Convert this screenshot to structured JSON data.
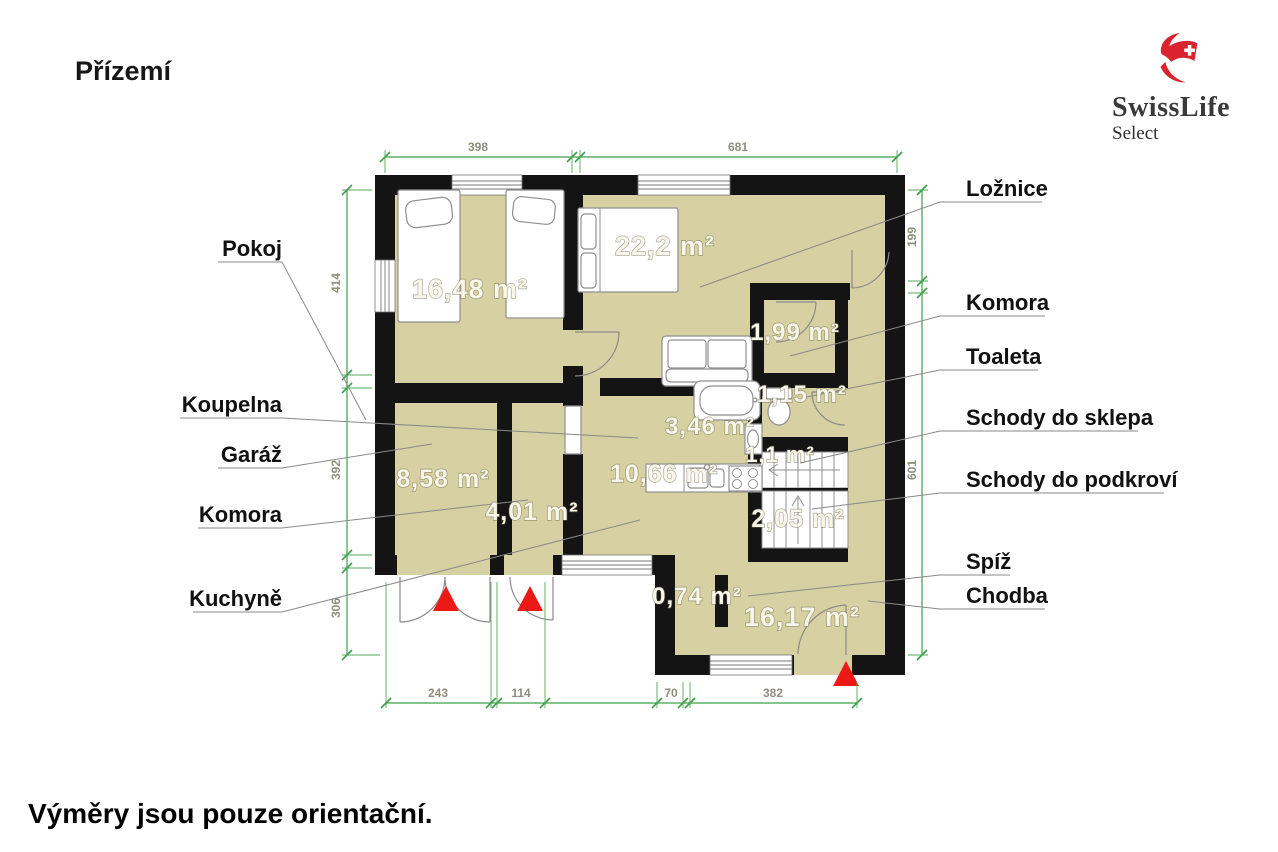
{
  "title": "Přízemí",
  "footer_note": "Výměry jsou pouze orientační.",
  "logo": {
    "brand": "SwissLife",
    "sub": "Select"
  },
  "colors": {
    "floor": "#d6d0a2",
    "wall": "#141414",
    "dimension_green": "#3da14b",
    "marker_red": "#ec1a16",
    "logo_red": "#d9232e"
  },
  "rooms": {
    "pokoj": {
      "label": "Pokoj",
      "area": "16,48 m²"
    },
    "loznice": {
      "label": "Ložnice",
      "area": "22,2 m²"
    },
    "komora_horni": {
      "label": "Komora",
      "area": "1,99 m²"
    },
    "toaleta": {
      "label": "Toaleta",
      "area": "1,15 m²"
    },
    "koupelna": {
      "label": "Koupelna",
      "area": "3,46 m²"
    },
    "schody_sklep": {
      "label": "Schody do sklepa",
      "area": "1,1 m²"
    },
    "kuchyne": {
      "label": "Kuchyně",
      "area": "10,66 m²"
    },
    "garaz": {
      "label": "Garáž",
      "area": "8,58 m²"
    },
    "komora_dolni": {
      "label": "Komora",
      "area": "4,01 m²"
    },
    "schody_podkrovi": {
      "label": "Schody do podkroví",
      "area": "2,05 m²"
    },
    "spiz": {
      "label": "Spíž",
      "area": "0,74 m²"
    },
    "chodba": {
      "label": "Chodba",
      "area": "16,17 m²"
    }
  },
  "dimensions": {
    "top": [
      "398",
      "681"
    ],
    "left": [
      "414",
      "392",
      "306"
    ],
    "right": [
      "199",
      "601"
    ],
    "bottom": [
      "243",
      "114",
      "70",
      "382"
    ]
  }
}
